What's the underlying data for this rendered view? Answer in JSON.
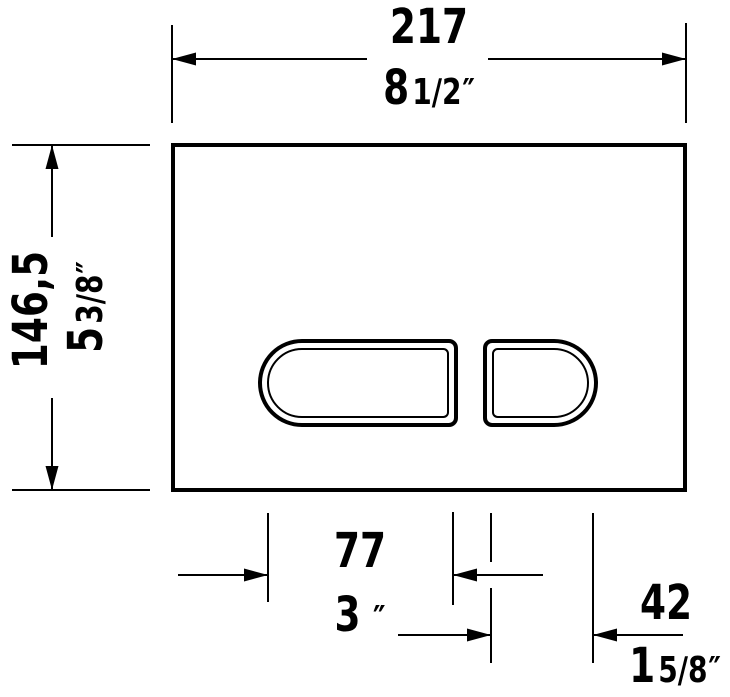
{
  "drawing": {
    "type": "technical-dimension-drawing",
    "subject": "flush-actuator-plate-front-view"
  },
  "colors": {
    "line": "#000000",
    "background": "#ffffff"
  },
  "dimensions": {
    "plate_width": {
      "mm": "217",
      "inch_whole": "8",
      "inch_frac": "1/2",
      "inch_mark": "″"
    },
    "plate_height": {
      "mm": "146,5",
      "inch_whole": "5",
      "inch_frac": "3/8",
      "inch_mark": "″"
    },
    "large_button_width": {
      "mm": "77",
      "inch_whole": "3",
      "inch_frac": "",
      "inch_mark": "″"
    },
    "small_button_width": {
      "mm": "42",
      "inch_whole": "1",
      "inch_frac": "5/8",
      "inch_mark": "″"
    }
  }
}
